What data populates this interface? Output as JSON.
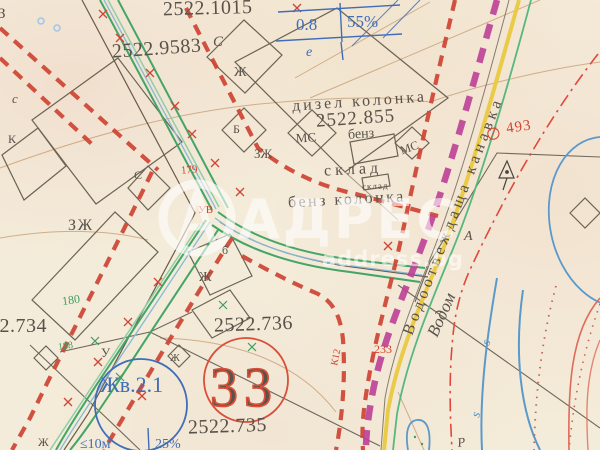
{
  "map_type": "cadastral-regulation-plan",
  "watermark": {
    "brand": "АДРЕС",
    "site": "address.bg",
    "logo": "a-ring-logo"
  },
  "zone_table_top": {
    "density": "0.8",
    "intensity": "55%",
    "note": "е"
  },
  "zone_table_bottom": {
    "height": "≤10м",
    "coverage": "25%"
  },
  "parcels": {
    "p1": "2522.1015",
    "p2": "2522.9583",
    "p3": "2522.855",
    "p4": "2522.736",
    "p5": "2522.735",
    "p6": "2522.734"
  },
  "zone_circle": {
    "label": "Жв.2.1"
  },
  "block_circle": {
    "number": "33"
  },
  "poi": {
    "diesel_pump": "дизел колонка",
    "benz_pump": "бенз колонка",
    "benz": "бенз",
    "ms_a": "МС",
    "ms_b": "МС",
    "warehouse_a": "склад",
    "warehouse_b": "склад"
  },
  "canal": {
    "name": "Водоотвеждаща канавка"
  },
  "stream": {
    "name": "Водом",
    "s1": "s",
    "s2": "s",
    "r_mark": "Р"
  },
  "pipe": {
    "symbol": "∅",
    "diameter": "493"
  },
  "survey": {
    "m179": "179",
    "m180": "180",
    "m188": "188",
    "m233": "233",
    "uv": "УВ",
    "k12": "К12"
  },
  "letters": [
    {
      "t": "З"
    },
    {
      "t": "с"
    },
    {
      "t": "К"
    },
    {
      "t": "С"
    },
    {
      "t": "ЗЖ"
    },
    {
      "t": "С"
    },
    {
      "t": "Ж"
    },
    {
      "t": "Б"
    },
    {
      "t": "ЗЖ"
    },
    {
      "t": "Ж"
    },
    {
      "t": "б"
    },
    {
      "t": "Ж"
    },
    {
      "t": "У"
    },
    {
      "t": "Ж"
    },
    {
      "t": "А"
    }
  ],
  "colors": {
    "paper": "#f4ecda",
    "regulation_red": "#cf4434",
    "street_green": "#43a566",
    "canal_magenta": "#bc3f96",
    "canal_yellow": "#e9c93f",
    "water_blue": "#5b99cc",
    "ink_dark": "#59524a",
    "cadastre_brown": "#c49a70",
    "blue_text": "#3f6db8",
    "red_text": "#d5452e",
    "green_text": "#3f9e5f"
  }
}
